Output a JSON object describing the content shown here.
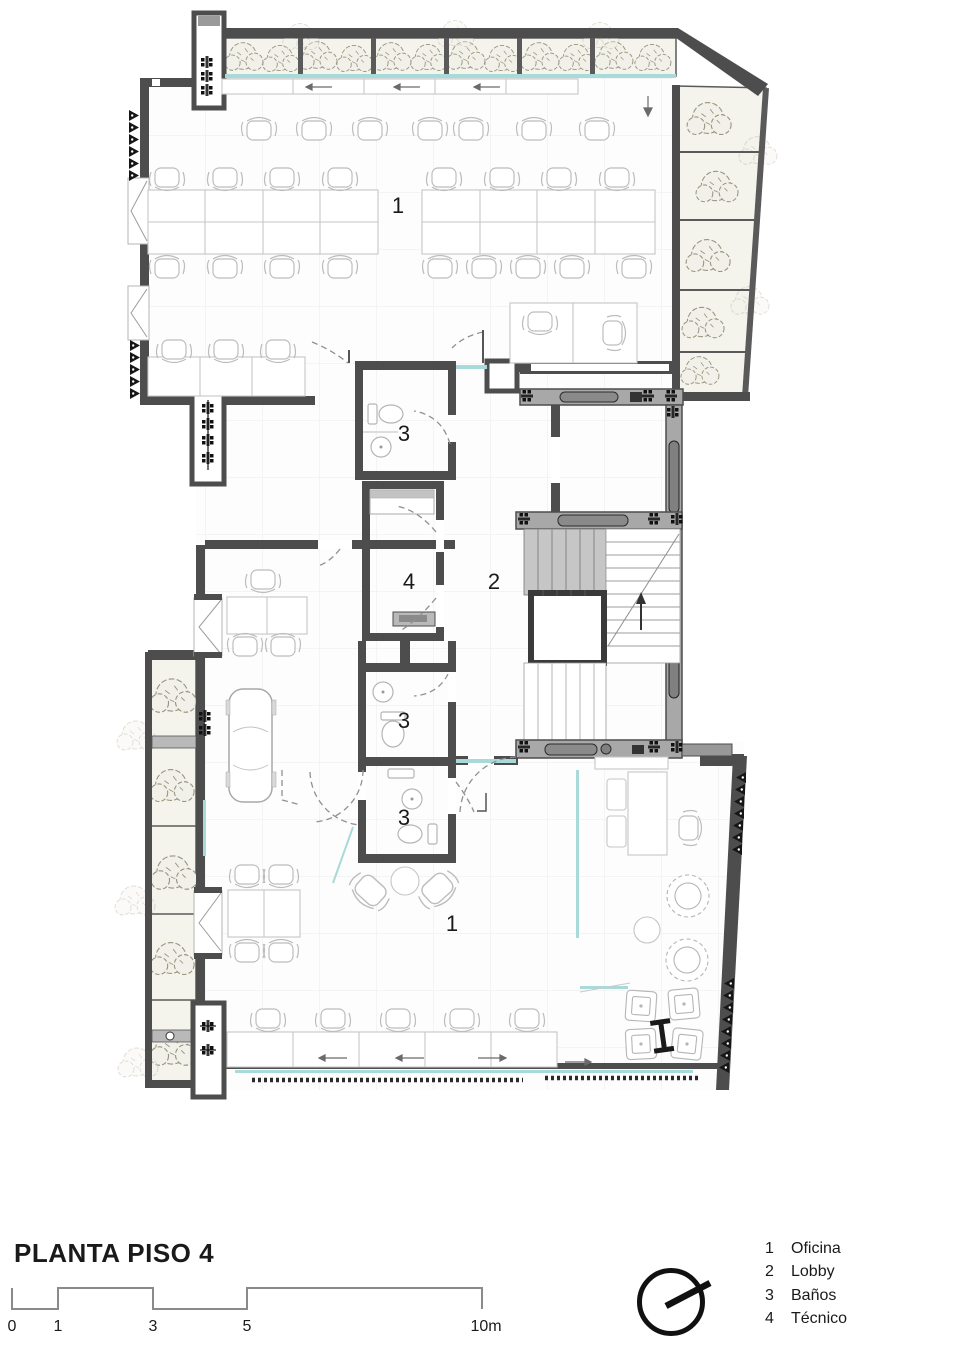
{
  "colors": {
    "wall": "#4d4d4d",
    "core_gray": "#a8a8a8",
    "glass_teal": "#a9dada",
    "vegetation": "#98957e",
    "ink": "#1a1a1a"
  },
  "plan": {
    "room_labels": [
      {
        "n": "1"
      },
      {
        "n": "1"
      },
      {
        "n": "2"
      },
      {
        "n": "3"
      },
      {
        "n": "3"
      },
      {
        "n": "3"
      },
      {
        "n": "4"
      }
    ]
  },
  "footer": {
    "title": "PLANTA PISO 4",
    "scale_labels": [
      "0",
      "1",
      "3",
      "5",
      "10m"
    ],
    "legend": [
      {
        "num": "1",
        "label": "Oficina"
      },
      {
        "num": "2",
        "label": "Lobby"
      },
      {
        "num": "3",
        "label": "Baños"
      },
      {
        "num": "4",
        "label": "Técnico"
      }
    ]
  }
}
